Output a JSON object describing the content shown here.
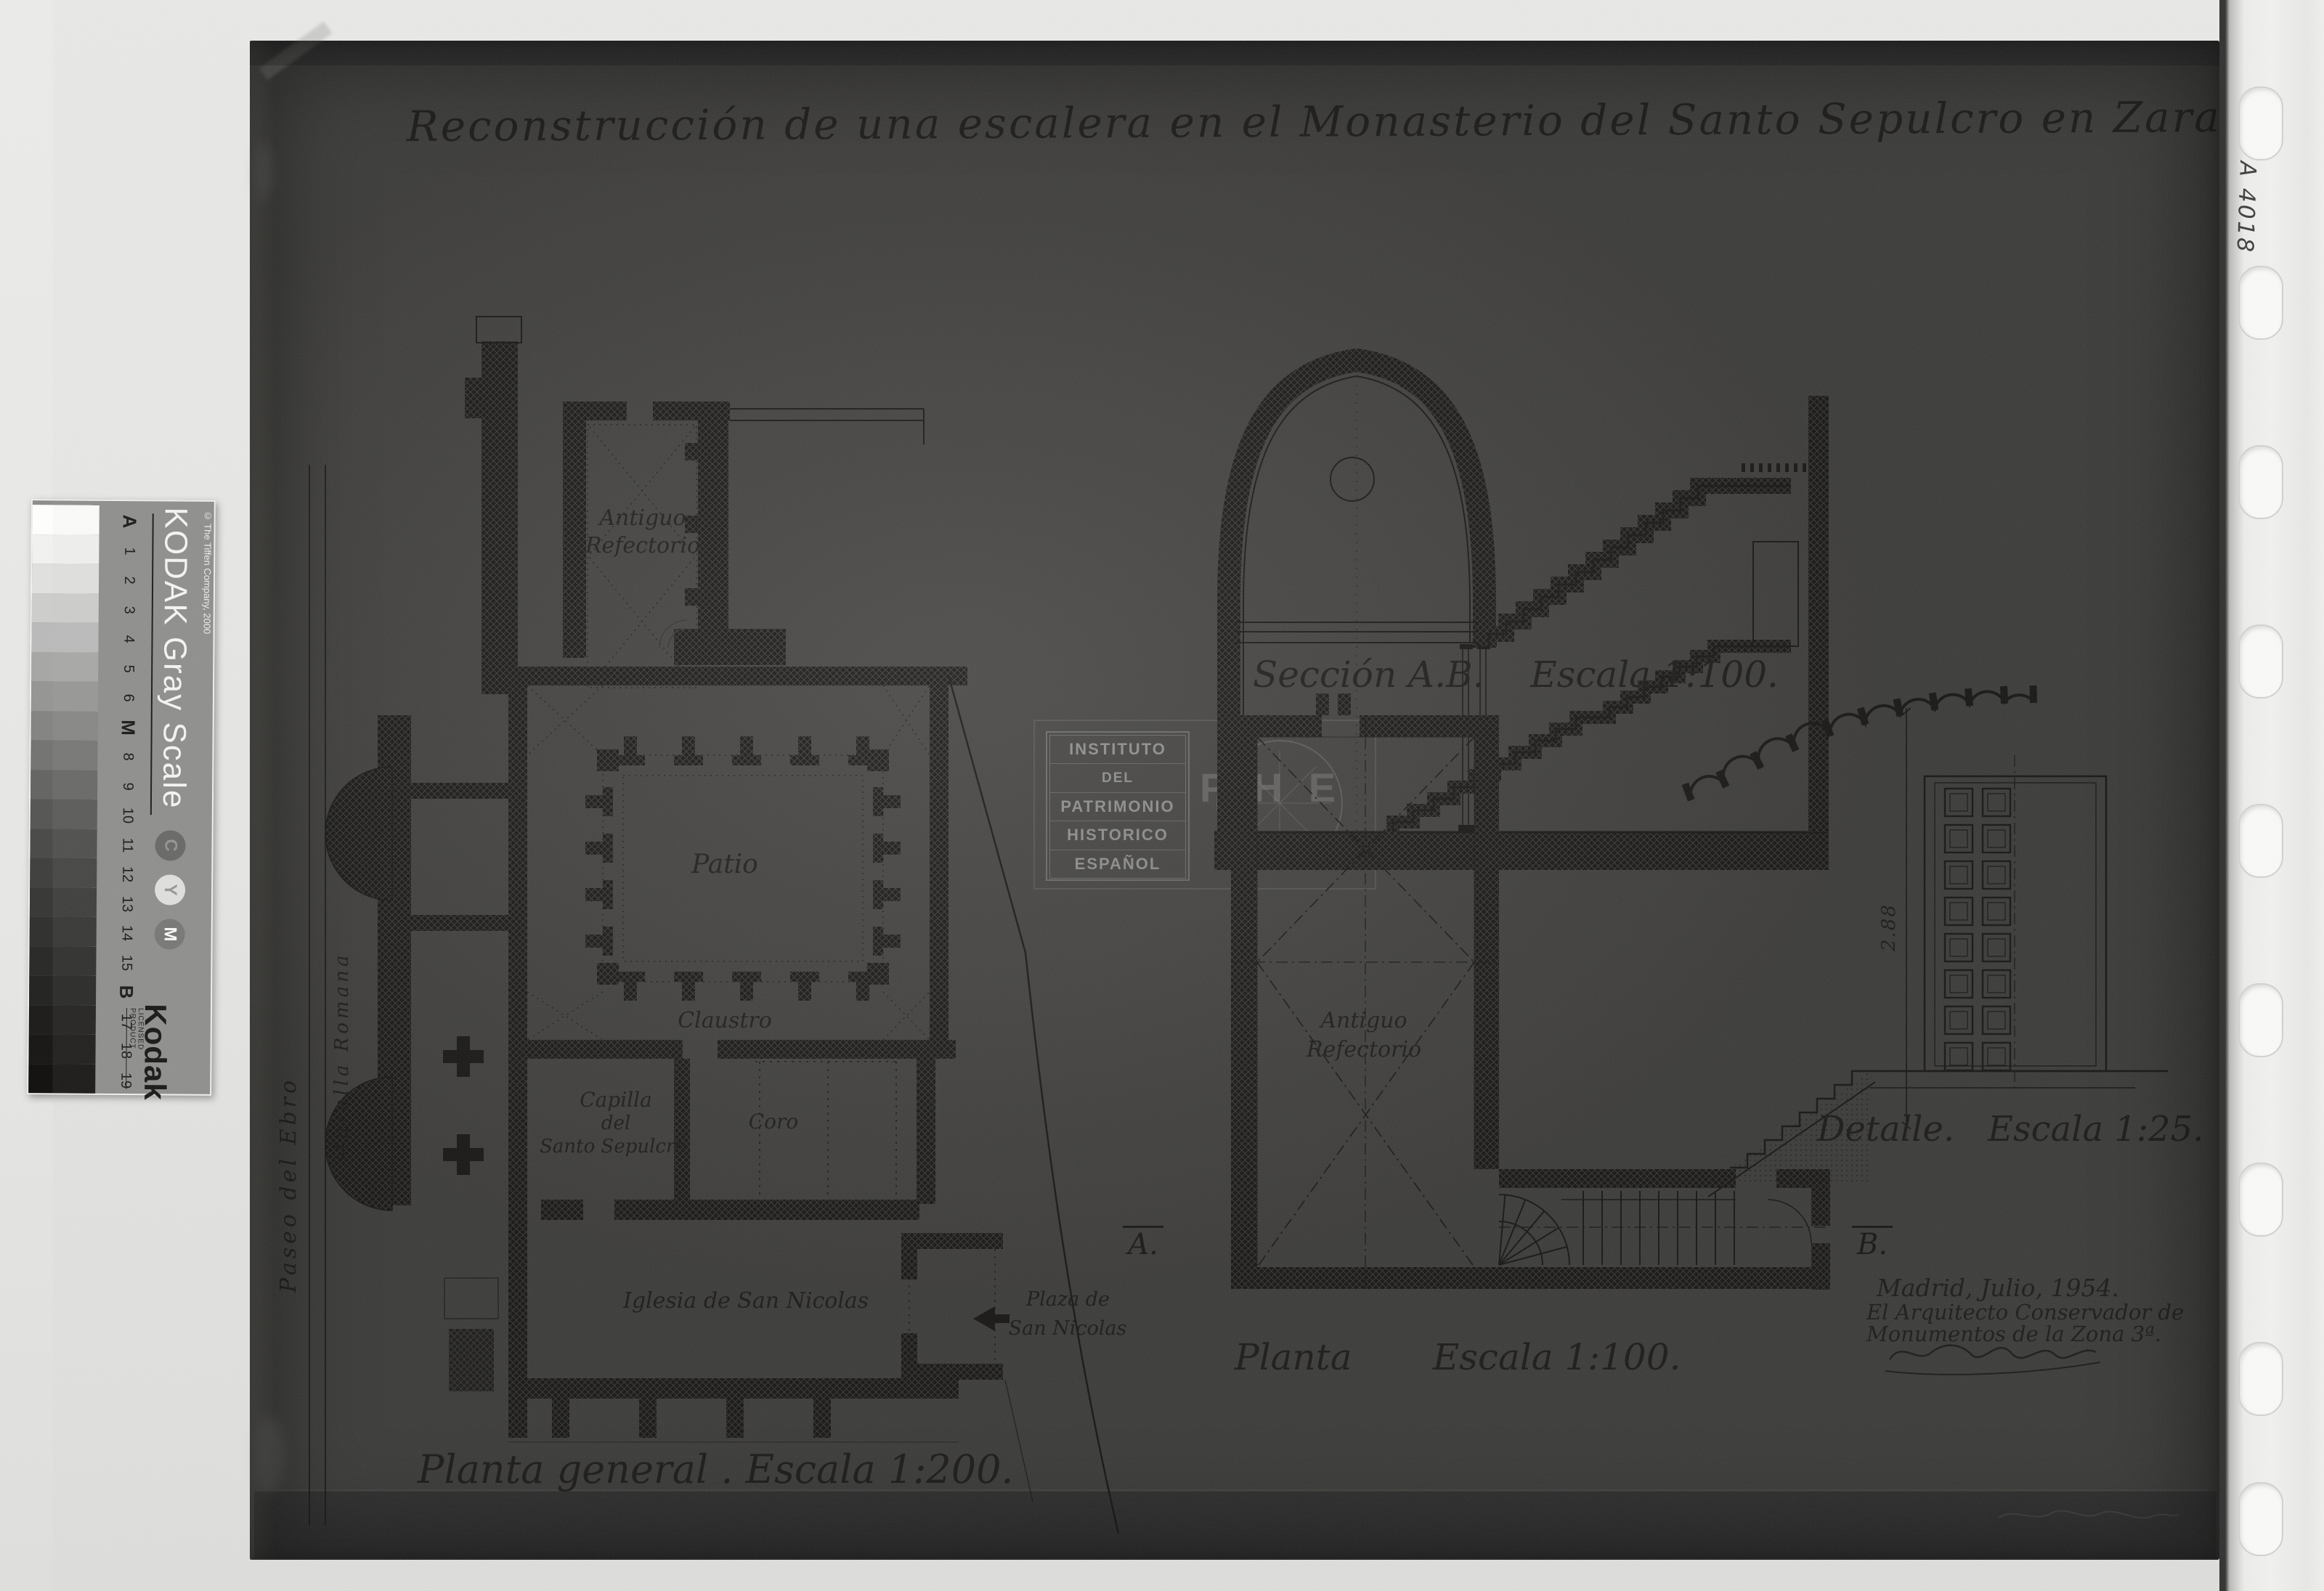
{
  "colors": {
    "photo_background": "#424140",
    "ink": "#161514",
    "stamp_ink": "#a3a3a1",
    "margin_paper": "#e7e7e5",
    "gray_scale_band": "#8d8d8b"
  },
  "photo": {
    "title": "Reconstrucción de una escalera en el Monasterio del Santo Sepulcro en Zaragoza.",
    "archive_mark": "A 4018",
    "general_plan": {
      "caption": "Planta general . Escala 1:200.",
      "refectorio_1": "Antiguo",
      "refectorio_2": "Refectorio",
      "patio": "Patio",
      "claustro": "Claustro",
      "capilla_1": "Capilla",
      "capilla_2": "del",
      "capilla_3": "Santo Sepulcro.",
      "coro": "Coro",
      "iglesia": "Iglesia de San Nicolas",
      "plaza_1": "Plaza de",
      "plaza_2": "San Nicolas",
      "paseo_del_ebro": "Paseo del Ebro",
      "muralla_romana": "Muralla Romana"
    },
    "section": {
      "caption": "Sección A.B.    Escala 1:100."
    },
    "plan_100": {
      "caption": "Planta       Escala 1:100.",
      "refectorio_1": "Antiguo",
      "refectorio_2": "Refectorio",
      "marker_a": "A.",
      "marker_b": "B."
    },
    "detail": {
      "caption": "Detalle.   Escala 1:25.",
      "dimension": "2.88"
    },
    "stamp": {
      "line1": "INSTITUTO",
      "line2": "DEL",
      "line3": "PATRIMONIO",
      "line4": "HISTORICO",
      "line5": "ESPAÑOL",
      "monogram": "PHE"
    },
    "signature": {
      "line1": "Madrid, Julio, 1954.",
      "line2": "El Arquitecto Conservador de",
      "line3": "Monumentos de la Zona 3ª."
    }
  },
  "gray_scale": {
    "title": "KODAK Gray Scale",
    "copyright": "© The Tiffen Company, 2000",
    "steps": [
      "A",
      "1",
      "2",
      "3",
      "4",
      "5",
      "6",
      "M",
      "8",
      "9",
      "10",
      "11",
      "12",
      "13",
      "14",
      "15",
      "B",
      "17",
      "18",
      "19"
    ],
    "patch_colors": [
      "#fdfdfb",
      "#f1f1ef",
      "#e0e0de",
      "#cdcdcb",
      "#bababa",
      "#a7a7a5",
      "#969694",
      "#858583",
      "#757573",
      "#666664",
      "#585856",
      "#4c4c4a",
      "#424240",
      "#3a3a38",
      "#333331",
      "#2c2c2a",
      "#262624",
      "#211f1e",
      "#1b1a19",
      "#151413"
    ],
    "cym": [
      "C",
      "Y",
      "M"
    ],
    "brand": "Kodak",
    "licensed": "LICENSED PRODUCT"
  }
}
